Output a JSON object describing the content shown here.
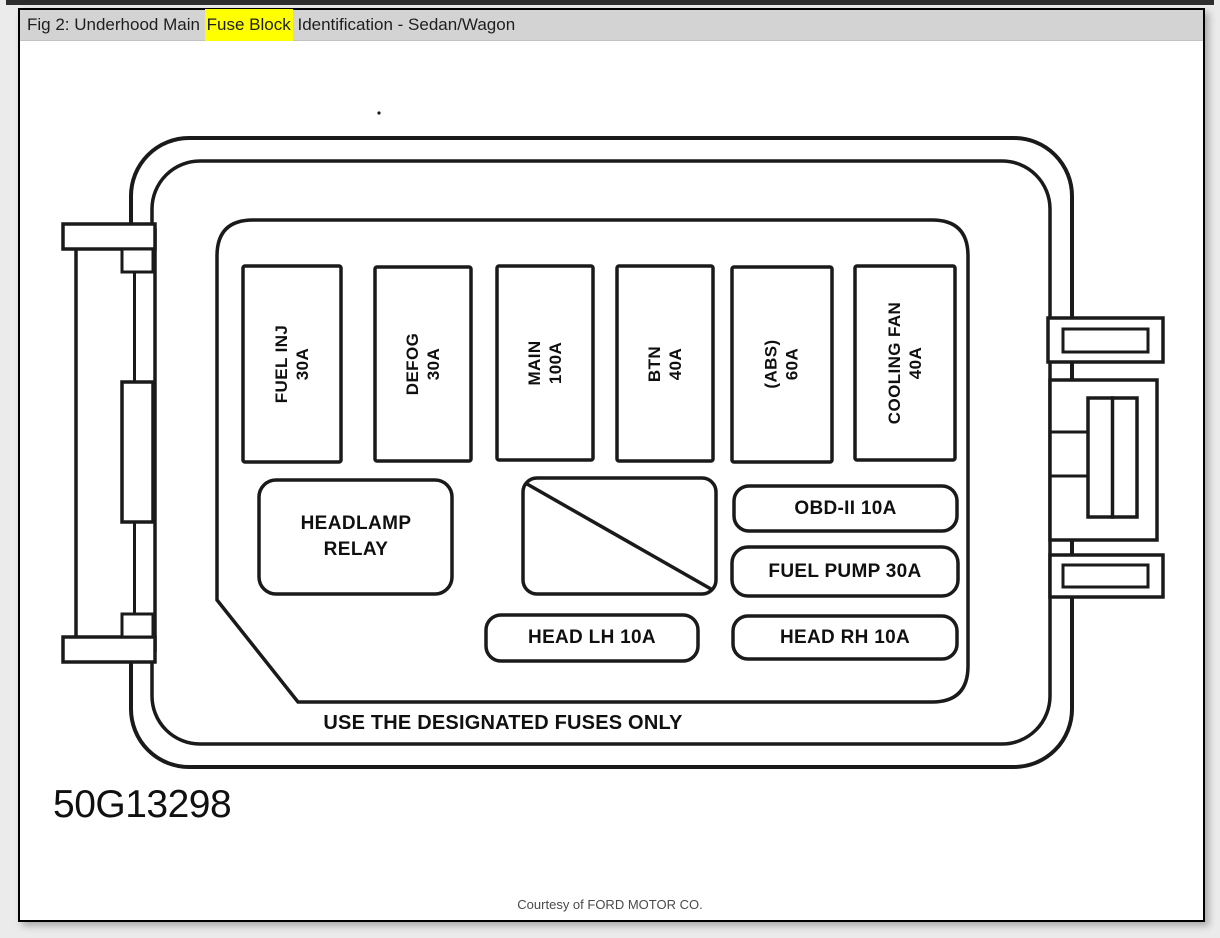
{
  "header": {
    "title_prefix": "Fig 2: Underhood Main ",
    "title_highlight": "Fuse Block",
    "title_suffix": " Identification - Sedan/Wagon"
  },
  "colors": {
    "highlight": "#ffff00",
    "header_bar": "#d3d3d3",
    "line": "#1a1a1a"
  },
  "diagram": {
    "vertical_fuses": [
      {
        "label": "FUEL INJ",
        "amp": "30A"
      },
      {
        "label": "DEFOG",
        "amp": "30A"
      },
      {
        "label": "MAIN",
        "amp": "100A"
      },
      {
        "label": "BTN",
        "amp": "40A"
      },
      {
        "label": "(ABS)",
        "amp": "60A"
      },
      {
        "label": "COOLING FAN",
        "amp": "40A"
      }
    ],
    "relay": {
      "line1": "HEADLAMP",
      "line2": "RELAY"
    },
    "small_fuses": [
      {
        "label": "OBD-II 10A"
      },
      {
        "label": "FUEL PUMP 30A"
      },
      {
        "label": "HEAD LH 10A"
      },
      {
        "label": "HEAD RH 10A"
      }
    ],
    "warning": "USE THE DESIGNATED FUSES ONLY",
    "part_number": "50G13298"
  },
  "footer": {
    "credit": "Courtesy of FORD MOTOR CO."
  }
}
